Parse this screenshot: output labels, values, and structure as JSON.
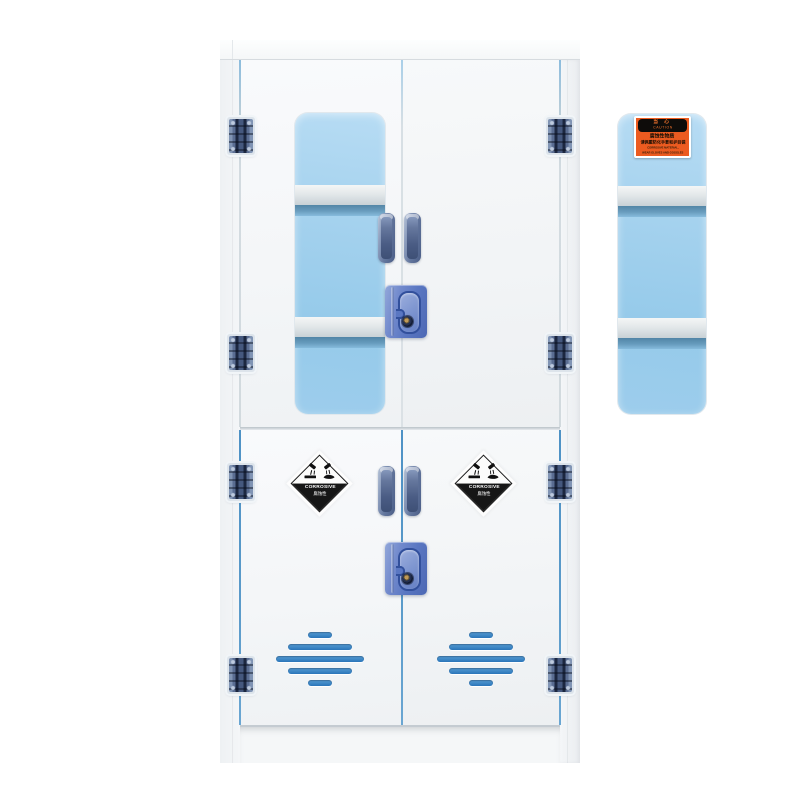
{
  "caution_label": {
    "warn_cn": "当 心",
    "warn_en": "CAUTION",
    "line1": "腐蚀性物质",
    "line2": "请佩戴防化手套和护目镜",
    "line3": "CORROSIVE MATERIAL,",
    "line4": "WEAR GLOVES AND GOGGLES"
  },
  "corrosive_label": {
    "text_en": "CORROSIVE",
    "text_cn": "腐蚀性"
  },
  "colors": {
    "cabinet_white": "#f4f6f8",
    "window_blue_top": "#b7dcf4",
    "window_blue_bottom": "#95caea",
    "hardware_lock_blue": "#5a77c2",
    "hinge_blue": "#5a6d92",
    "vent_blue": "#2a75b9",
    "gap_blue": "#4e92c5",
    "caution_orange": "#ec5b20",
    "label_black": "#161616"
  }
}
